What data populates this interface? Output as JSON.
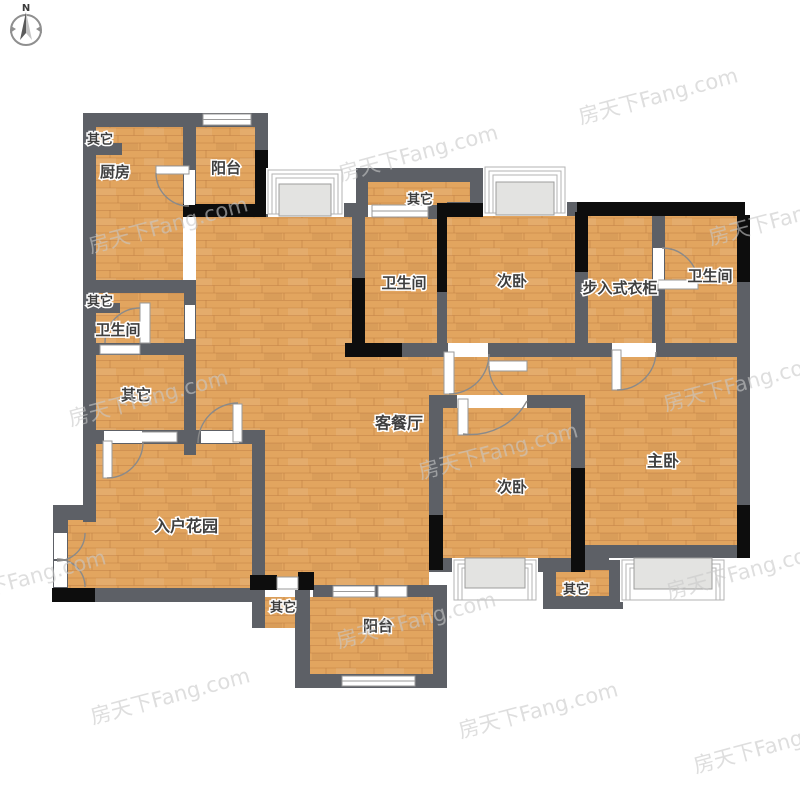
{
  "compass": {
    "north_label": "N"
  },
  "watermark": {
    "text": "房天下Fang.com",
    "color": "#c9c9c9"
  },
  "colors": {
    "wall_gray": "#5d6066",
    "wall_black": "#0d0d0d",
    "floor_wood": "#e2a55f",
    "window_white": "#ffffff",
    "bay_fill": "#e3e3e1",
    "background": "#ffffff",
    "label_text": "#3f3f3f"
  },
  "rooms": {
    "other_top_left": {
      "label": "其它"
    },
    "kitchen": {
      "label": "厨房"
    },
    "balcony_top": {
      "label": "阳台"
    },
    "other_top_middle": {
      "label": "其它"
    },
    "bathroom_middle": {
      "label": "卫生间"
    },
    "bedroom_second_top": {
      "label": "次卧"
    },
    "walk_in_closet": {
      "label": "步入式衣柜"
    },
    "bathroom_right": {
      "label": "卫生间"
    },
    "other_left": {
      "label": "其它"
    },
    "bathroom_left": {
      "label": "卫生间"
    },
    "other_middle_left": {
      "label": "其它"
    },
    "living_dining": {
      "label": "客餐厅"
    },
    "entrance_garden": {
      "label": "入户花园"
    },
    "bedroom_second_bottom": {
      "label": "次卧"
    },
    "master_bedroom": {
      "label": "主卧"
    },
    "other_bottom_left": {
      "label": "其它"
    },
    "balcony_bottom": {
      "label": "阳台"
    },
    "other_bottom_right": {
      "label": "其它"
    }
  }
}
